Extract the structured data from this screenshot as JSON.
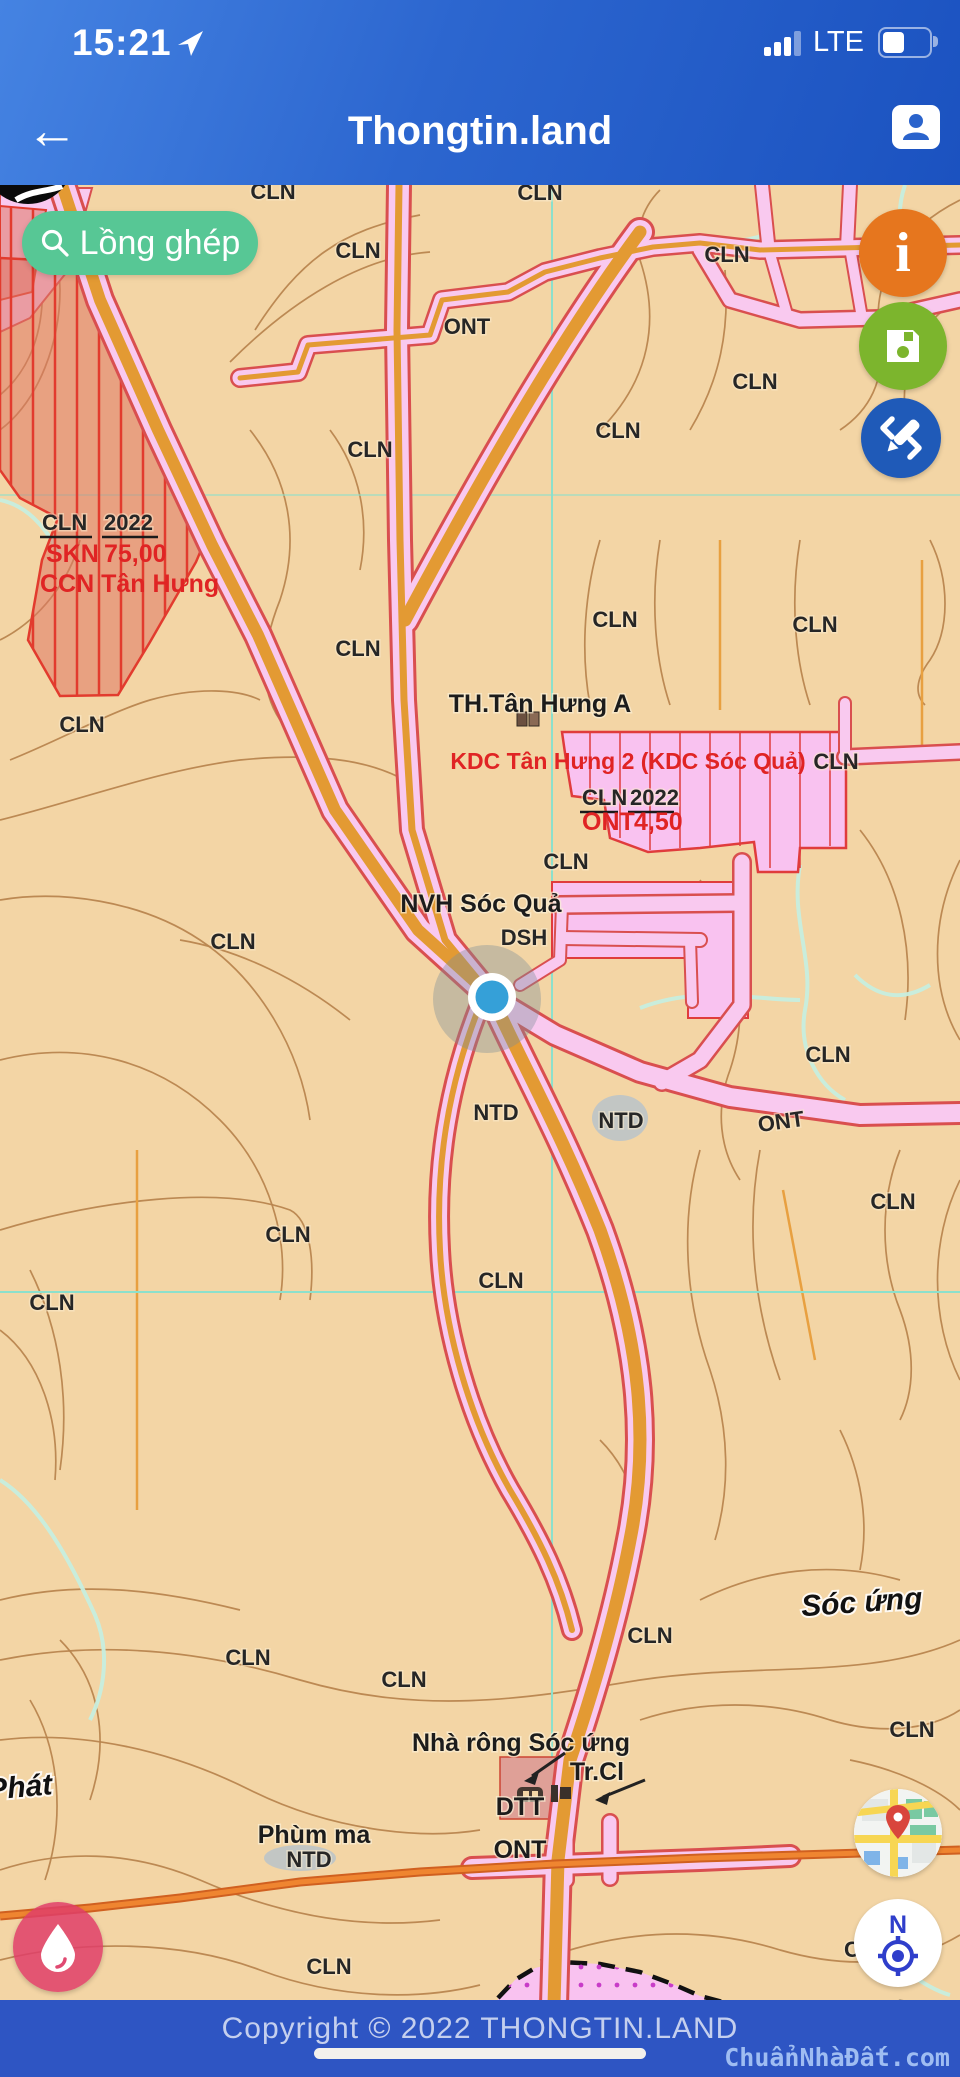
{
  "status_bar": {
    "time": "15:21",
    "network": "LTE"
  },
  "header": {
    "title": "Thongtin.land"
  },
  "search": {
    "label": "Lồng ghép"
  },
  "controls": {
    "info_glyph": "i",
    "compass_north": "N"
  },
  "map": {
    "cln_labels": [
      "CLN",
      "CLN",
      "CLN",
      "CLN",
      "CLN",
      "CLN",
      "CLN",
      "CLN",
      "CLN",
      "CLN",
      "CLN",
      "CLN",
      "CLN",
      "CLN",
      "CLN",
      "CLN",
      "CLN",
      "CLN",
      "CLN",
      "CLN",
      "CLN",
      "CLN",
      "CLN",
      "CLN"
    ],
    "ont_labels": [
      "ONT",
      "ONT",
      "ONT"
    ],
    "ntd_labels": [
      "NTD",
      "NTD",
      "NTD"
    ],
    "dsh_label": "DSH",
    "places": {
      "th": "TH.Tân Hưng A",
      "nvh": "NVH Sóc Quả",
      "soc_ung": "Sóc ứng",
      "nha_rong": "Nhà rông Sóc ứng",
      "tr_cl": "Tr.Cl",
      "dtt": "DTT",
      "phum_ma": "Phùm ma",
      "phat": "Phát",
      "partial_c": "C"
    },
    "ccn": {
      "l1a": "CLN",
      "l1b": "2022",
      "l2a": "SKN",
      "l2b": "75,00",
      "l3": "CCN Tân Hưng"
    },
    "kdc": {
      "title": "KDC Tân Hưng 2 (KDC Sóc Quả)",
      "l1a": "CLN",
      "l1b": "2022",
      "l2a": "ONT",
      "l2b": "4,50"
    }
  },
  "footer": {
    "copyright": "Copyright © 2022 THONGTIN.LAND",
    "watermark": "ChuẩnNhàĐất.com"
  },
  "colors": {
    "header_blue": "#2c66cf",
    "footer_blue": "#2e55c3",
    "search_green": "#57c795",
    "info_orange": "#e6761e",
    "save_green": "#7cb52d",
    "draw_blue": "#1f5ab8",
    "drop_pink": "#e04a72",
    "map_tan": "#f3d5a5",
    "road_pink": "#f9c9ef",
    "road_edge_red": "#d94f4f",
    "road_core_orange": "#e39a33",
    "parcel_pink": "#f9c2f0",
    "hatch_red": "#e23b2e",
    "grid_cyan": "#8ce0cc",
    "compass_blue": "#2f3ecb"
  }
}
